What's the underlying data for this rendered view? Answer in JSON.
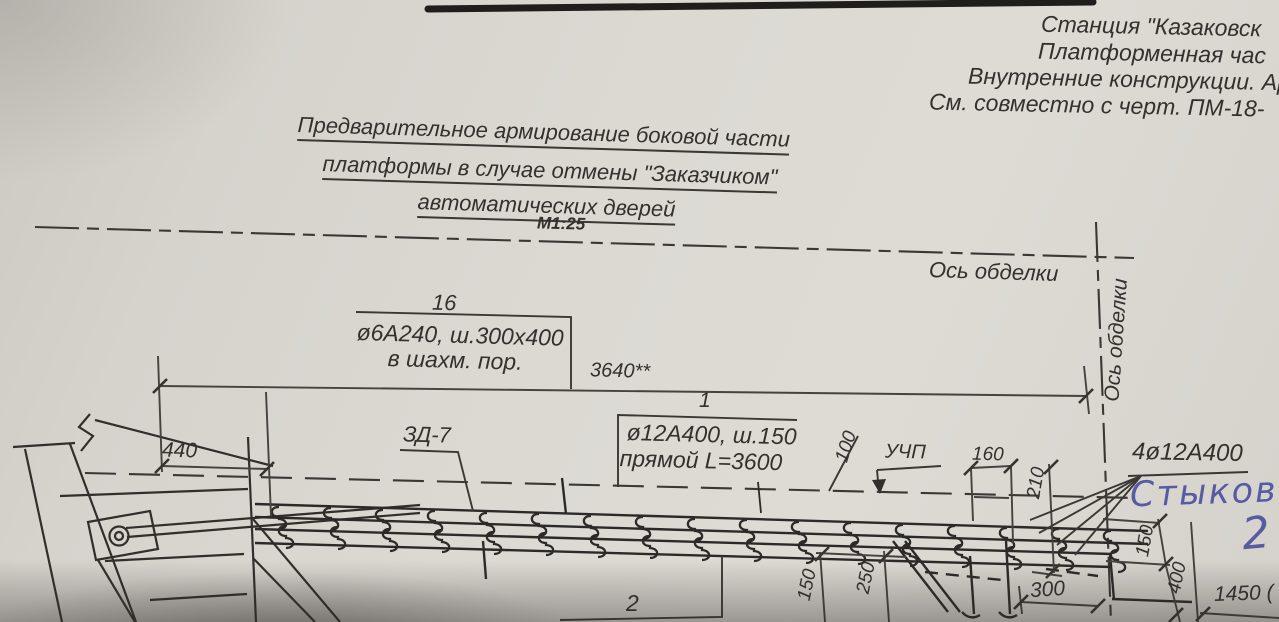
{
  "header": {
    "line1": "Станция \"Казаковск",
    "line2": "Платформенная час",
    "line3": "Внутренние конструкции. Ар",
    "line4": "См. совместно с черт. ПМ-18-"
  },
  "title": {
    "line1": "Предварительное армирование  боковой части",
    "line2": "платформы в случае отмены \"Заказчиком\"",
    "line3": "автоматических дверей",
    "scale": "М1:25"
  },
  "axes": {
    "lining_axis_horizontal": "Ось обделки",
    "lining_axis_vertical": "Ось обделки"
  },
  "callouts": {
    "mesh_number": "16",
    "mesh_spec": "ø6А240, ш.300х400",
    "mesh_note": "в шахм. пор.",
    "bar_number": "1",
    "bar_spec": "ø12А400, ш.150",
    "bar_note": "прямой L=3600",
    "embed_mark": "ЗД-7",
    "floor_level": "УЧП",
    "corner_bars": "4ø12А400",
    "item2_number": "2"
  },
  "dimensions": {
    "overall": "3640**",
    "d440": "440",
    "d100": "100",
    "d160": "160",
    "d210": "210",
    "d150_mid": "150",
    "d250": "250",
    "d300": "300",
    "d150_right": "150",
    "d400": "400",
    "d1450": "1450 ("
  },
  "handwriting": {
    "note": "Стыковка",
    "number": "2"
  },
  "colors": {
    "ink": "#3a3835",
    "handwriting": "#4d519e",
    "paper": "#d8d5cf"
  }
}
